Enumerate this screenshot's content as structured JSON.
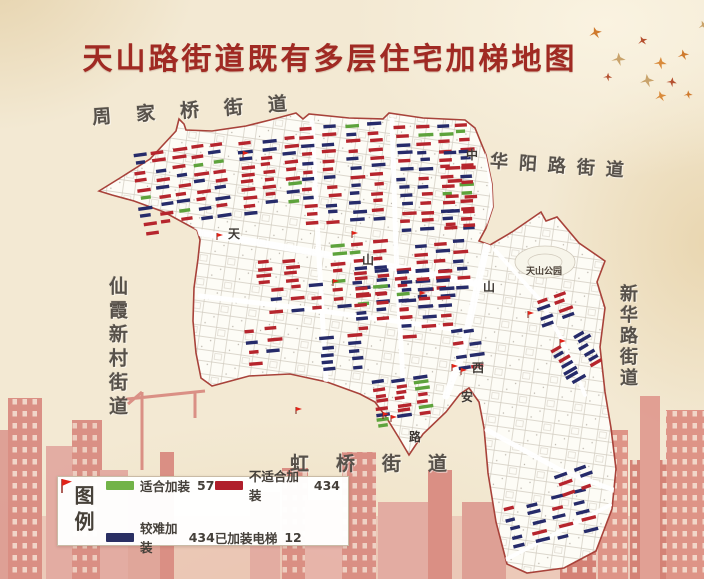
{
  "title": {
    "text": "天山路街道既有多层住宅加梯地图"
  },
  "districts": {
    "top_left": "周家桥街道",
    "top_right": "华阳路街道",
    "left": "仙霞新村街道",
    "right": "新华路街道",
    "bottom": "虹桥街道"
  },
  "legend": {
    "title": "图例",
    "items": [
      {
        "label": "适合加装",
        "count": 57,
        "color": "#72b348",
        "type": "bar"
      },
      {
        "label": "不适合加装",
        "count": 434,
        "color": "#b01f2c",
        "type": "bar"
      },
      {
        "label": "较难加装",
        "count": 434,
        "color": "#2a2f63",
        "type": "bar"
      },
      {
        "label": "已加装电梯",
        "count": 12,
        "color": "#e02318",
        "type": "flag"
      }
    ]
  },
  "map": {
    "park_label": "天山公园",
    "road_labels": [
      {
        "ch": "天",
        "x": 228,
        "y": 225
      },
      {
        "ch": "山",
        "x": 362,
        "y": 251
      },
      {
        "ch": "中",
        "x": 466,
        "y": 146
      },
      {
        "ch": "山",
        "x": 483,
        "y": 278
      },
      {
        "ch": "西",
        "x": 472,
        "y": 359
      },
      {
        "ch": "安",
        "x": 461,
        "y": 388
      },
      {
        "ch": "路",
        "x": 409,
        "y": 428
      }
    ],
    "building_colors": {
      "suitable": "#5ea33c",
      "difficult": "#262b6a",
      "unsuitable": "#b6252d"
    },
    "building_clusters": [
      {
        "x": 136,
        "y": 146,
        "w": 96,
        "h": 88,
        "n": 46,
        "rot": -8,
        "mix": [
          0.5,
          0.38,
          0.12
        ]
      },
      {
        "x": 238,
        "y": 138,
        "w": 70,
        "h": 76,
        "n": 28,
        "rot": -6,
        "mix": [
          0.6,
          0.35,
          0.05
        ]
      },
      {
        "x": 300,
        "y": 122,
        "w": 92,
        "h": 104,
        "n": 48,
        "rot": -4,
        "mix": [
          0.62,
          0.33,
          0.05
        ]
      },
      {
        "x": 396,
        "y": 122,
        "w": 82,
        "h": 112,
        "n": 52,
        "rot": -3,
        "mix": [
          0.58,
          0.37,
          0.05
        ]
      },
      {
        "x": 444,
        "y": 150,
        "w": 32,
        "h": 86,
        "n": 12,
        "rot": -3,
        "mix": [
          0.6,
          0.4,
          0.0
        ]
      },
      {
        "x": 415,
        "y": 240,
        "w": 58,
        "h": 62,
        "n": 20,
        "rot": -4,
        "mix": [
          0.6,
          0.4,
          0.0
        ]
      },
      {
        "x": 255,
        "y": 258,
        "w": 56,
        "h": 26,
        "n": 8,
        "rot": -5,
        "mix": [
          0.8,
          0.15,
          0.05
        ]
      },
      {
        "x": 330,
        "y": 240,
        "w": 64,
        "h": 70,
        "n": 24,
        "rot": -5,
        "mix": [
          0.5,
          0.28,
          0.22
        ]
      },
      {
        "x": 352,
        "y": 268,
        "w": 66,
        "h": 62,
        "n": 22,
        "rot": -5,
        "mix": [
          0.6,
          0.35,
          0.05
        ]
      },
      {
        "x": 398,
        "y": 268,
        "w": 58,
        "h": 72,
        "n": 22,
        "rot": -4,
        "mix": [
          0.55,
          0.45,
          0.0
        ]
      },
      {
        "x": 454,
        "y": 328,
        "w": 24,
        "h": 50,
        "n": 8,
        "rot": -8,
        "mix": [
          0.2,
          0.8,
          0.0
        ]
      },
      {
        "x": 536,
        "y": 294,
        "w": 40,
        "h": 30,
        "n": 8,
        "rot": -20,
        "mix": [
          0.45,
          0.55,
          0.0
        ]
      },
      {
        "x": 556,
        "y": 334,
        "w": 52,
        "h": 44,
        "n": 13,
        "rot": -30,
        "mix": [
          0.3,
          0.7,
          0.0
        ]
      },
      {
        "x": 268,
        "y": 284,
        "w": 60,
        "h": 34,
        "n": 9,
        "rot": -5,
        "mix": [
          0.6,
          0.35,
          0.05
        ]
      },
      {
        "x": 246,
        "y": 326,
        "w": 40,
        "h": 46,
        "n": 7,
        "rot": -5,
        "mix": [
          0.5,
          0.5,
          0.0
        ]
      },
      {
        "x": 320,
        "y": 334,
        "w": 54,
        "h": 38,
        "n": 10,
        "rot": -5,
        "mix": [
          0.3,
          0.7,
          0.0
        ]
      },
      {
        "x": 374,
        "y": 376,
        "w": 60,
        "h": 50,
        "n": 22,
        "rot": -8,
        "mix": [
          0.7,
          0.12,
          0.18
        ]
      },
      {
        "x": 506,
        "y": 496,
        "w": 94,
        "h": 48,
        "n": 20,
        "rot": -14,
        "mix": [
          0.2,
          0.8,
          0.0
        ]
      },
      {
        "x": 556,
        "y": 466,
        "w": 42,
        "h": 30,
        "n": 6,
        "rot": -20,
        "mix": [
          0.5,
          0.5,
          0.0
        ]
      }
    ],
    "flags": [
      [
        217,
        240
      ],
      [
        243,
        158
      ],
      [
        333,
        286
      ],
      [
        352,
        238
      ],
      [
        452,
        371
      ],
      [
        461,
        375
      ],
      [
        383,
        419
      ],
      [
        391,
        422
      ],
      [
        296,
        414
      ],
      [
        528,
        318
      ],
      [
        560,
        346
      ],
      [
        420,
        298
      ]
    ]
  }
}
